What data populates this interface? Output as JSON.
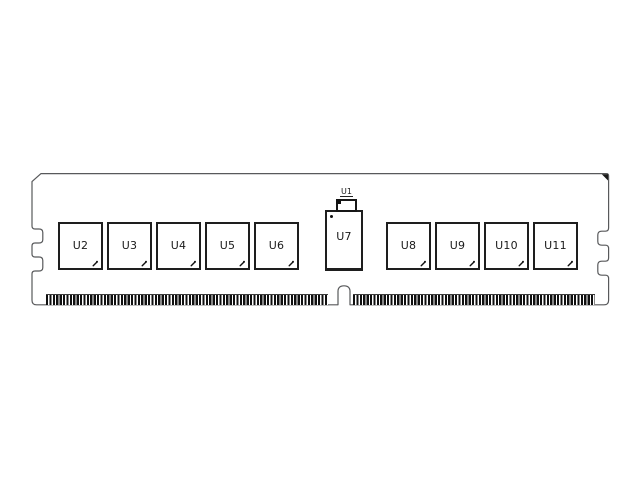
{
  "module": {
    "colors": {
      "background": "#ffffff",
      "outline": "#58595b",
      "chip_border": "#1e1e1e",
      "pin": "#101010",
      "label": "#1a1a1a"
    },
    "small_component": {
      "label": "U1"
    },
    "left_chips": [
      {
        "label": "U2"
      },
      {
        "label": "U3"
      },
      {
        "label": "U4"
      },
      {
        "label": "U5"
      },
      {
        "label": "U6"
      }
    ],
    "center_chip": {
      "label": "U7"
    },
    "right_chips": [
      {
        "label": "U8"
      },
      {
        "label": "U9"
      },
      {
        "label": "U10"
      },
      {
        "label": "U11"
      }
    ]
  }
}
